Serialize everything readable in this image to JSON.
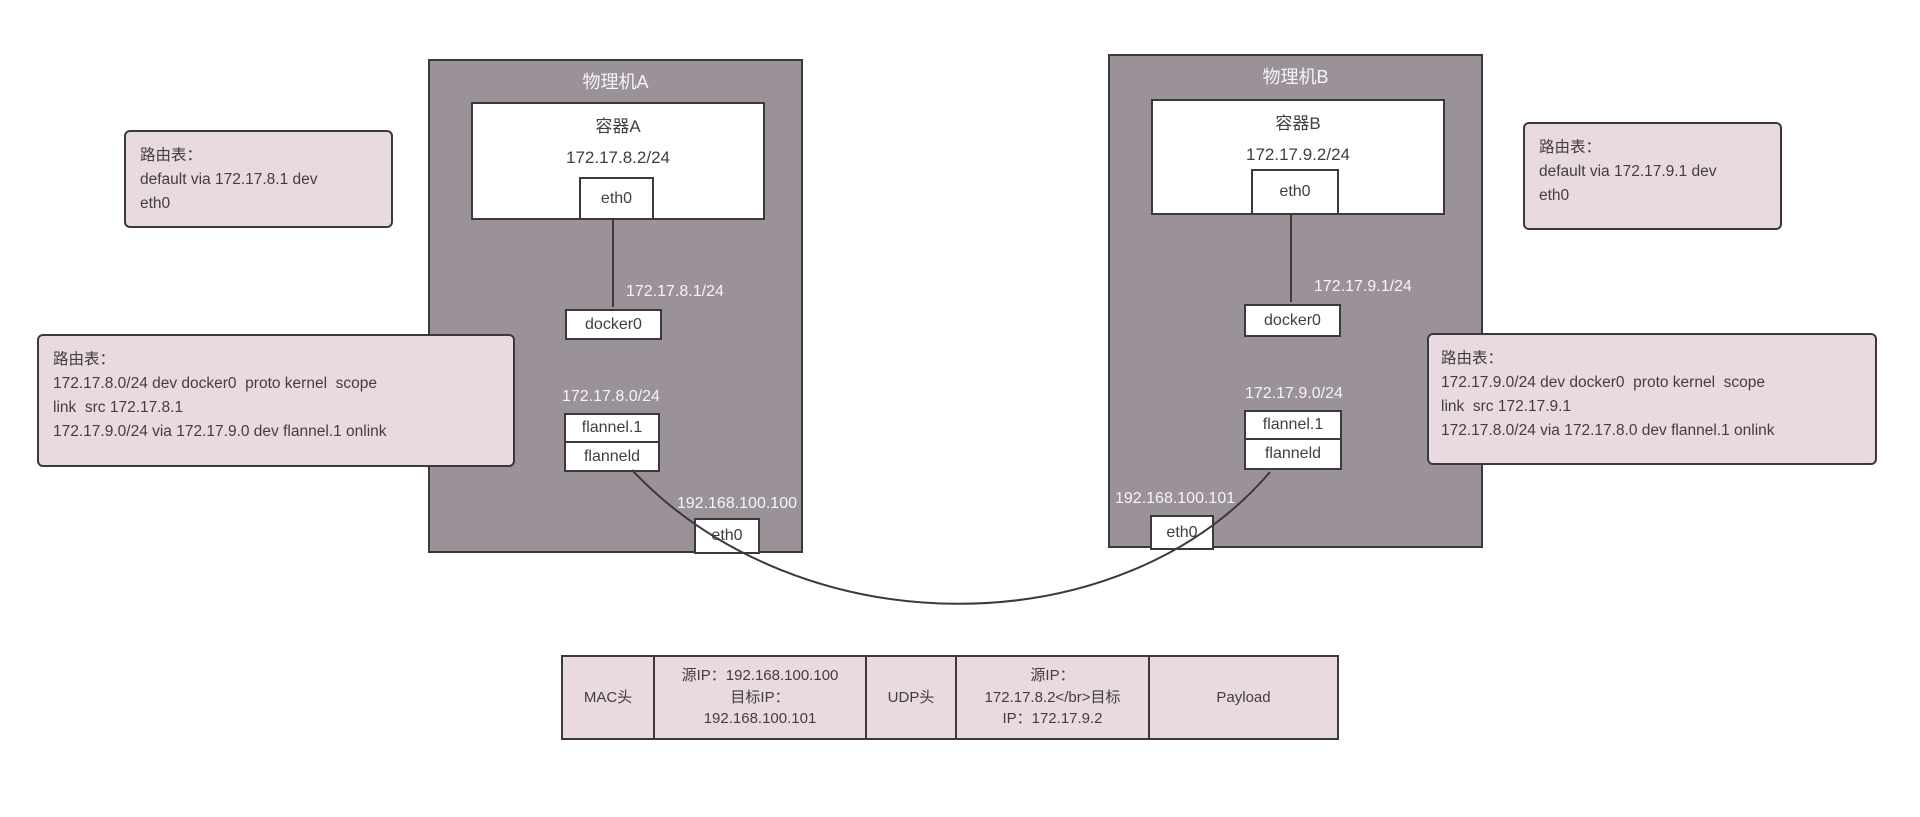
{
  "machines": {
    "a": {
      "title": "物理机A",
      "container": {
        "title": "容器A",
        "ip": "172.17.8.2/24",
        "eth0_label": "eth0"
      },
      "docker0_label": "docker0",
      "docker0_ip": "172.17.8.1/24",
      "flannel_subnet": "172.17.8.0/24",
      "flannel1_label": "flannel.1",
      "flanneld_label": "flanneld",
      "host_ip": "192.168.100.100",
      "eth0_label": "eth0"
    },
    "b": {
      "title": "物理机B",
      "container": {
        "title": "容器B",
        "ip": "172.17.9.2/24",
        "eth0_label": "eth0"
      },
      "docker0_label": "docker0",
      "docker0_ip": "172.17.9.1/24",
      "flannel_subnet": "172.17.9.0/24",
      "flannel1_label": "flannel.1",
      "flanneld_label": "flanneld",
      "host_ip": "192.168.100.101",
      "eth0_label": "eth0"
    }
  },
  "notes": {
    "container_a": {
      "lines": [
        "路由表：",
        "default via 172.17.8.1 dev",
        "eth0"
      ]
    },
    "host_a": {
      "lines": [
        "路由表：",
        "172.17.8.0/24 dev docker0  proto kernel  scope",
        "link  src 172.17.8.1",
        "172.17.9.0/24 via 172.17.9.0 dev flannel.1 onlink"
      ]
    },
    "container_b": {
      "lines": [
        "路由表：",
        "default via 172.17.9.1 dev",
        "eth0"
      ]
    },
    "host_b": {
      "lines": [
        "路由表：",
        "172.17.9.0/24 dev docker0  proto kernel  scope",
        "link  src 172.17.9.1",
        "172.17.8.0/24 via 172.17.8.0 dev flannel.1 onlink"
      ]
    }
  },
  "packet": {
    "cells": [
      {
        "name": "mac-header",
        "lines": [
          "MAC头"
        ]
      },
      {
        "name": "outer-ip-header",
        "lines": [
          "源IP：192.168.100.100",
          "目标IP：",
          "192.168.100.101"
        ]
      },
      {
        "name": "udp-header",
        "lines": [
          "UDP头"
        ]
      },
      {
        "name": "inner-ip-header",
        "lines": [
          "源IP：",
          "172.17.8.2</br>目标",
          "IP：172.17.9.2"
        ]
      },
      {
        "name": "payload",
        "lines": [
          "Payload"
        ]
      }
    ]
  },
  "colors": {
    "machine_bg": "#9b9299",
    "note_bg": "#e8dae0",
    "border": "#3d383c",
    "white_text": "#f6f4f5",
    "dark_text": "#413d40",
    "page_bg": "#ffffff"
  }
}
